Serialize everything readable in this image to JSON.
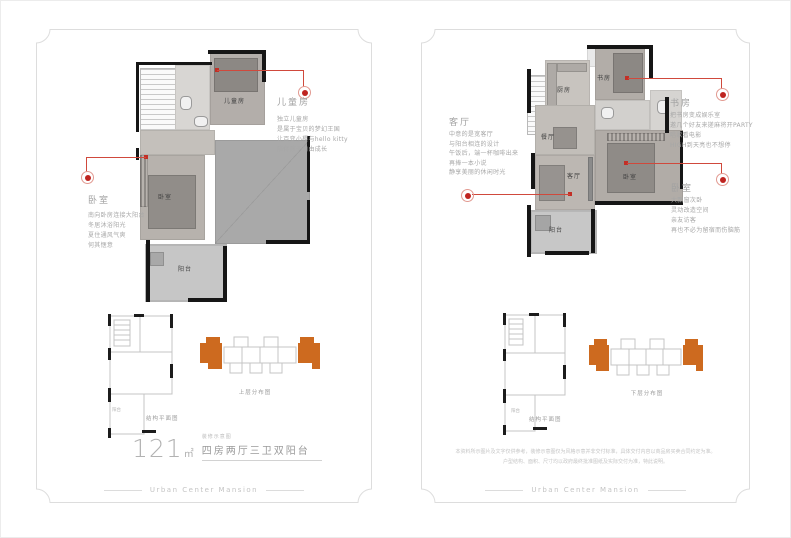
{
  "brand": {
    "footer": "Urban Center Mansion"
  },
  "colors": {
    "accent_red": "#c22f26",
    "accent_orange": "#cd6a1f",
    "wall_black": "#161616"
  },
  "left_panel": {
    "rooms": {
      "child": "儿童房",
      "bedroom": "卧室",
      "balcony": "阳台"
    },
    "annotations": {
      "child": {
        "title": "儿童房",
        "lines": [
          "独立儿童房",
          "是属于宝贝的梦幻王国",
          "让百变小樱与hello kitty",
          "陪伴孩子自由成长"
        ]
      },
      "bedroom": {
        "title": "卧室",
        "lines": [
          "南向卧房连接大阳台",
          "冬居沐浴阳光",
          "夏住通风气爽",
          "何其惬意"
        ]
      }
    },
    "structure_label": "结构平面图",
    "structure_balcony": "阳台",
    "distribution_label": "上层分布图",
    "area": {
      "value": "121",
      "unit": "㎡",
      "tag": "装修示意图",
      "desc": "四房两厅三卫双阳台"
    }
  },
  "right_panel": {
    "rooms": {
      "kitchen": "厨房",
      "study": "书房",
      "dining": "餐厅",
      "living": "客厅",
      "bedroom": "卧室",
      "balcony": "阳台"
    },
    "annotations": {
      "living": {
        "title": "客厅",
        "lines": [
          "中意的是宽客厅",
          "与阳台相连的设计",
          "午饭后，端一杯咖啡出来",
          "再捧一本小说",
          "静享美丽的休闲时光"
        ]
      },
      "study": {
        "title": "书房",
        "lines": [
          "把书房变成娱乐室",
          "邀几个好友来搓麻将开PARTY",
          "唱歌看电影",
          "HIGH到天亮也不想停"
        ]
      },
      "bedroom": {
        "title": "卧室",
        "lines": [
          "大飘窗次卧",
          "灵动改造空间",
          "亲友访客",
          "再也不必为留宿而伤脑筋"
        ]
      }
    },
    "structure_label": "结构平面图",
    "structure_balcony": "阳台",
    "distribution_label": "下层分布图",
    "disclaimer": [
      "本资料所示图片及文字仅供参考，装修示意图仅为风格示意并非交付标准，具体交付内容以商品房买卖合同约定为准。",
      "户型结构、面积、尺寸均以政府最终批准图纸及实际交付为准，特此说明。"
    ]
  }
}
